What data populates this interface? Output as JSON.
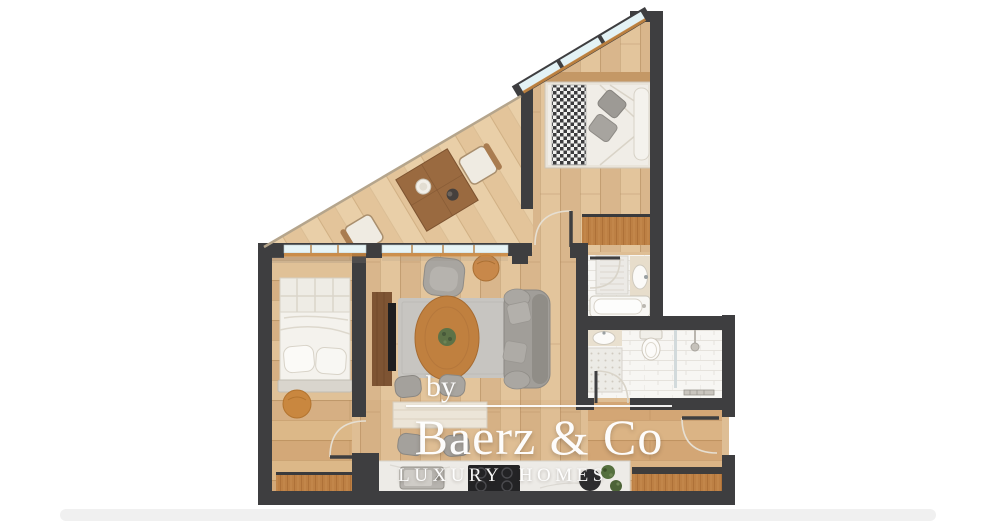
{
  "watermark": {
    "by": "by",
    "brand": "Baerz & Co",
    "tagline": "LUXURY HOMES"
  },
  "palette": {
    "wall": "#3e3e40",
    "floor_base": "#debe95",
    "floor_seam": "#b08a5d",
    "window_glass": "#e7f4f6",
    "window_frame": "#c8863f",
    "bathroom_floor": "#f7f6f3",
    "rug": "#c7c5c1",
    "sofa_gray": "#a19e99",
    "dining_wood": "#9a6a40",
    "accent_wood": "#c0803f",
    "wardrobe_wood": "#bd8044",
    "counter_white": "#edebe7",
    "cooktop_black": "#232325",
    "plant_green": "#55703f",
    "shadow_band": "#f0f0f0",
    "watermark_text": "#ffffff"
  },
  "elements": {
    "doors": [
      "entry-door",
      "bedroom-left-door",
      "bedroom-top-door",
      "bathroom-door",
      "ensuite-door",
      "shower-door"
    ],
    "furniture": [
      "double-bed-top",
      "double-bed-left",
      "dining-table",
      "dining-chair",
      "sofa",
      "armchair",
      "coffee-table",
      "plant-pot",
      "side-table",
      "tv-sideboard",
      "kitchen-island",
      "stool",
      "kitchen-counter",
      "kitchen-sink",
      "cooktop",
      "wardrobe",
      "bathtub",
      "shower-tray",
      "toilet",
      "washbasin",
      "towel-rail",
      "entry-cabinet",
      "round-rug",
      "bench"
    ]
  }
}
